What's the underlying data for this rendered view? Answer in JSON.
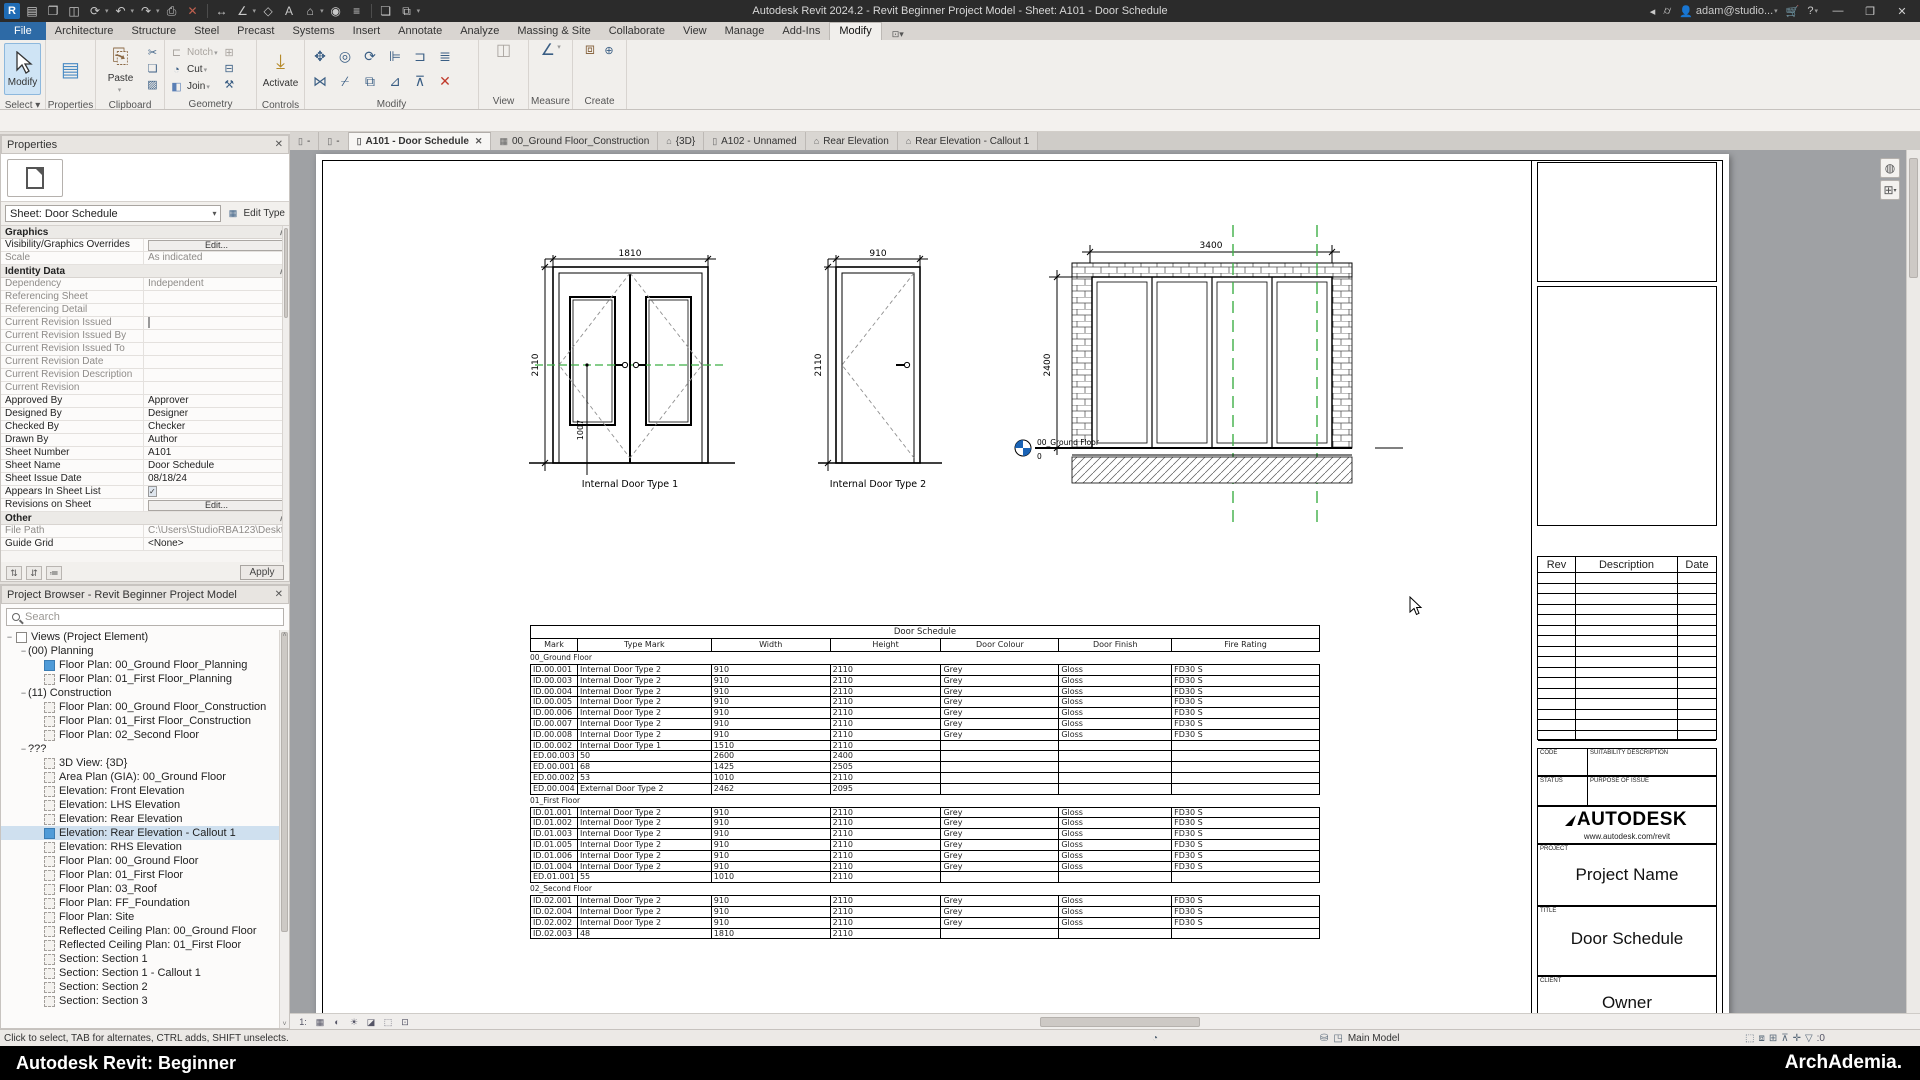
{
  "colors": {
    "accent_blue": "#2d6aa6",
    "selection": "#cfe0ef",
    "canvas_gray": "#9fa1a4",
    "green_dash": "#3faf46",
    "level_blue": "#1a63b5",
    "delete_red": "#c03a2b"
  },
  "titlebar": {
    "title": "Autodesk Revit 2024.2 - Revit Beginner Project Model - Sheet: A101 - Door Schedule",
    "account": "adam@studio...",
    "qat": [
      "revit-logo",
      "ui-toggle",
      "open",
      "save",
      "sync",
      "undo",
      "redo",
      "print",
      "transfer",
      "dimension",
      "measure",
      "tag",
      "text",
      "default-3d-view",
      "section",
      "thin-lines",
      "close-hidden",
      "switch-windows"
    ]
  },
  "ribbon": {
    "tabs": [
      {
        "label": "File",
        "file": true
      },
      {
        "label": "Architecture"
      },
      {
        "label": "Structure"
      },
      {
        "label": "Steel"
      },
      {
        "label": "Precast"
      },
      {
        "label": "Systems"
      },
      {
        "label": "Insert"
      },
      {
        "label": "Annotate"
      },
      {
        "label": "Analyze"
      },
      {
        "label": "Massing & Site"
      },
      {
        "label": "Collaborate"
      },
      {
        "label": "View"
      },
      {
        "label": "Manage"
      },
      {
        "label": "Add-Ins"
      },
      {
        "label": "Modify",
        "active": true
      }
    ],
    "select": {
      "button": "Modify",
      "caption": "Select"
    },
    "properties": {
      "caption": "Properties"
    },
    "clipboard": {
      "paste": "Paste",
      "caption": "Clipboard"
    },
    "geometry": {
      "notch": "Notch",
      "cut": "Cut",
      "join": "Join",
      "caption": "Geometry"
    },
    "controls": {
      "activate": "Activate",
      "caption": "Controls"
    },
    "modify": {
      "caption": "Modify"
    },
    "view": {
      "caption": "View"
    },
    "measure": {
      "caption": "Measure"
    },
    "create": {
      "caption": "Create"
    }
  },
  "properties_panel": {
    "header": "Properties",
    "type_label": "Sheet",
    "type_selector": "Sheet: Door Schedule",
    "edit_type": "Edit Type",
    "apply": "Apply",
    "sections": [
      {
        "title": "Graphics",
        "rows": [
          {
            "label": "Visibility/Graphics Overrides",
            "control": "button",
            "value": "Edit..."
          },
          {
            "label": "Scale",
            "value": "As indicated",
            "disabled": true
          }
        ]
      },
      {
        "title": "Identity Data",
        "rows": [
          {
            "label": "Dependency",
            "value": "Independent",
            "disabled": true
          },
          {
            "label": "Referencing Sheet",
            "value": "",
            "disabled": true
          },
          {
            "label": "Referencing Detail",
            "value": "",
            "disabled": true
          },
          {
            "label": "Current Revision Issued",
            "control": "check",
            "disabled": true
          },
          {
            "label": "Current Revision Issued By",
            "value": "",
            "disabled": true
          },
          {
            "label": "Current Revision Issued To",
            "value": "",
            "disabled": true
          },
          {
            "label": "Current Revision Date",
            "value": "",
            "disabled": true
          },
          {
            "label": "Current Revision Description",
            "value": "",
            "disabled": true
          },
          {
            "label": "Current Revision",
            "value": "",
            "disabled": true
          },
          {
            "label": "Approved By",
            "value": "Approver"
          },
          {
            "label": "Designed By",
            "value": "Designer"
          },
          {
            "label": "Checked By",
            "value": "Checker"
          },
          {
            "label": "Drawn By",
            "value": "Author"
          },
          {
            "label": "Sheet Number",
            "value": "A101"
          },
          {
            "label": "Sheet Name",
            "value": "Door Schedule"
          },
          {
            "label": "Sheet Issue Date",
            "value": "08/18/24"
          },
          {
            "label": "Appears In Sheet List",
            "control": "check-on"
          },
          {
            "label": "Revisions on Sheet",
            "control": "button",
            "value": "Edit..."
          }
        ]
      },
      {
        "title": "Other",
        "rows": [
          {
            "label": "File Path",
            "value": "C:\\Users\\StudioRBA123\\Deskto...",
            "disabled": true
          },
          {
            "label": "Guide Grid",
            "value": "<None>"
          }
        ]
      }
    ]
  },
  "project_browser": {
    "header": "Project Browser - Revit Beginner Project Model",
    "search_placeholder": "Search",
    "items": [
      {
        "label": "Views (Project Element)",
        "depth": 0,
        "icon": "root",
        "expander": true
      },
      {
        "label": "(00) Planning",
        "depth": 1,
        "expander": true
      },
      {
        "label": "Floor Plan: 00_Ground Floor_Planning",
        "depth": 2,
        "icon": "view-blue"
      },
      {
        "label": "Floor Plan: 01_First Floor_Planning",
        "depth": 2,
        "icon": "view"
      },
      {
        "label": "(11) Construction",
        "depth": 1,
        "expander": true
      },
      {
        "label": "Floor Plan: 00_Ground Floor_Construction",
        "depth": 2,
        "icon": "view"
      },
      {
        "label": "Floor Plan: 01_First Floor_Construction",
        "depth": 2,
        "icon": "view"
      },
      {
        "label": "Floor Plan: 02_Second Floor",
        "depth": 2,
        "icon": "view"
      },
      {
        "label": "???",
        "depth": 1,
        "expander": true
      },
      {
        "label": "3D View: {3D}",
        "depth": 2,
        "icon": "view"
      },
      {
        "label": "Area Plan (GIA): 00_Ground Floor",
        "depth": 2,
        "icon": "view"
      },
      {
        "label": "Elevation: Front Elevation",
        "depth": 2,
        "icon": "view"
      },
      {
        "label": "Elevation: LHS Elevation",
        "depth": 2,
        "icon": "view"
      },
      {
        "label": "Elevation: Rear Elevation",
        "depth": 2,
        "icon": "view"
      },
      {
        "label": "Elevation: Rear Elevation - Callout 1",
        "depth": 2,
        "icon": "view-blue",
        "selected": true
      },
      {
        "label": "Elevation: RHS Elevation",
        "depth": 2,
        "icon": "view"
      },
      {
        "label": "Floor Plan: 00_Ground Floor",
        "depth": 2,
        "icon": "view"
      },
      {
        "label": "Floor Plan: 01_First Floor",
        "depth": 2,
        "icon": "view"
      },
      {
        "label": "Floor Plan: 03_Roof",
        "depth": 2,
        "icon": "view"
      },
      {
        "label": "Floor Plan: FF_Foundation",
        "depth": 2,
        "icon": "view"
      },
      {
        "label": "Floor Plan: Site",
        "depth": 2,
        "icon": "view"
      },
      {
        "label": "Reflected Ceiling Plan: 00_Ground Floor",
        "depth": 2,
        "icon": "view"
      },
      {
        "label": "Reflected Ceiling Plan: 01_First Floor",
        "depth": 2,
        "icon": "view"
      },
      {
        "label": "Section: Section 1",
        "depth": 2,
        "icon": "view"
      },
      {
        "label": "Section: Section 1 - Callout 1",
        "depth": 2,
        "icon": "view"
      },
      {
        "label": "Section: Section 2",
        "depth": 2,
        "icon": "view"
      },
      {
        "label": "Section: Section 3",
        "depth": 2,
        "icon": "view"
      }
    ]
  },
  "view_tabs": [
    {
      "label": "-",
      "icon": "sheet"
    },
    {
      "label": "-",
      "icon": "sheet"
    },
    {
      "label": "A101 - Door Schedule",
      "icon": "sheet",
      "active": true,
      "close": true
    },
    {
      "label": "00_Ground Floor_Construction",
      "icon": "plan"
    },
    {
      "label": "{3D}",
      "icon": "home"
    },
    {
      "label": "A102 - Unnamed",
      "icon": "sheet"
    },
    {
      "label": "Rear Elevation",
      "icon": "elevation"
    },
    {
      "label": "Rear Elevation - Callout 1",
      "icon": "elevation"
    }
  ],
  "sheet": {
    "drawings": {
      "door1": {
        "width_dim": "1810",
        "height_dim": "2110",
        "leaf_dim": "1007",
        "label": "Internal Door Type 1"
      },
      "door2": {
        "width_dim": "910",
        "height_dim": "2110",
        "label": "Internal Door Type 2"
      },
      "elevation": {
        "width_dim": "3400",
        "height_dim": "2400",
        "level_name": "00_Ground Floor",
        "level_value": "0"
      }
    },
    "schedule": {
      "title": "Door Schedule",
      "columns": [
        "Mark",
        "Type Mark",
        "Width",
        "Height",
        "Door Colour",
        "Door Finish",
        "Fire Rating"
      ],
      "col_widths": [
        47,
        134,
        119,
        111,
        118,
        113,
        148
      ],
      "groups": [
        {
          "name": "00_Ground Floor",
          "rows": [
            [
              "ID.00.001",
              "Internal Door Type 2",
              "910",
              "2110",
              "Grey",
              "Gloss",
              "FD30 S"
            ],
            [
              "ID.00.003",
              "Internal Door Type 2",
              "910",
              "2110",
              "Grey",
              "Gloss",
              "FD30 S"
            ],
            [
              "ID.00.004",
              "Internal Door Type 2",
              "910",
              "2110",
              "Grey",
              "Gloss",
              "FD30 S"
            ],
            [
              "ID.00.005",
              "Internal Door Type 2",
              "910",
              "2110",
              "Grey",
              "Gloss",
              "FD30 S"
            ],
            [
              "ID.00.006",
              "Internal Door Type 2",
              "910",
              "2110",
              "Grey",
              "Gloss",
              "FD30 S"
            ],
            [
              "ID.00.007",
              "Internal Door Type 2",
              "910",
              "2110",
              "Grey",
              "Gloss",
              "FD30 S"
            ],
            [
              "ID.00.008",
              "Internal Door Type 2",
              "910",
              "2110",
              "Grey",
              "Gloss",
              "FD30 S"
            ],
            [
              "ID.00.002",
              "Internal Door Type 1",
              "1510",
              "2110",
              "",
              "",
              ""
            ],
            [
              "ED.00.003",
              "50",
              "2600",
              "2400",
              "",
              "",
              ""
            ],
            [
              "ED.00.001",
              "68",
              "1425",
              "2505",
              "",
              "",
              ""
            ],
            [
              "ED.00.002",
              "53",
              "1010",
              "2110",
              "",
              "",
              ""
            ],
            [
              "ED.00.004",
              "External Door Type 2",
              "2462",
              "2095",
              "",
              "",
              ""
            ]
          ]
        },
        {
          "name": "01_First Floor",
          "rows": [
            [
              "ID.01.001",
              "Internal Door Type 2",
              "910",
              "2110",
              "Grey",
              "Gloss",
              "FD30 S"
            ],
            [
              "ID.01.002",
              "Internal Door Type 2",
              "910",
              "2110",
              "Grey",
              "Gloss",
              "FD30 S"
            ],
            [
              "ID.01.003",
              "Internal Door Type 2",
              "910",
              "2110",
              "Grey",
              "Gloss",
              "FD30 S"
            ],
            [
              "ID.01.005",
              "Internal Door Type 2",
              "910",
              "2110",
              "Grey",
              "Gloss",
              "FD30 S"
            ],
            [
              "ID.01.006",
              "Internal Door Type 2",
              "910",
              "2110",
              "Grey",
              "Gloss",
              "FD30 S"
            ],
            [
              "ID.01.004",
              "Internal Door Type 2",
              "910",
              "2110",
              "Grey",
              "Gloss",
              "FD30 S"
            ],
            [
              "ED.01.001",
              "55",
              "1010",
              "2110",
              "",
              "",
              ""
            ]
          ]
        },
        {
          "name": "02_Second Floor",
          "rows": [
            [
              "ID.02.001",
              "Internal Door Type 2",
              "910",
              "2110",
              "Grey",
              "Gloss",
              "FD30 S"
            ],
            [
              "ID.02.004",
              "Internal Door Type 2",
              "910",
              "2110",
              "Grey",
              "Gloss",
              "FD30 S"
            ],
            [
              "ID.02.002",
              "Internal Door Type 2",
              "910",
              "2110",
              "Grey",
              "Gloss",
              "FD30 S"
            ],
            [
              "ID.02.003",
              "48",
              "1810",
              "2110",
              "",
              "",
              ""
            ]
          ]
        }
      ]
    },
    "titleblock": {
      "rev": "Rev",
      "description": "Description",
      "date": "Date",
      "empty_rows": 16,
      "code_label": "CODE",
      "code_value": "SUITABILITY DESCRIPTION",
      "status_label": "STATUS",
      "status_value": "PURPOSE OF ISSUE",
      "brand": "AUTODESK",
      "brand_url": "www.autodesk.com/revit",
      "project_label": "PROJECT",
      "project_value": "Project Name",
      "title_label": "TITLE",
      "title_value": "Door Schedule",
      "client_label": "CLIENT",
      "client_value": "Owner"
    }
  },
  "statusbar": {
    "hint": "Click to select, TAB for alternates, CTRL adds, SHIFT unselects.",
    "main_model": "Main Model",
    "filter_count": ":0"
  },
  "footer": {
    "left": "Autodesk Revit: Beginner",
    "right": "ArchAdemia."
  }
}
